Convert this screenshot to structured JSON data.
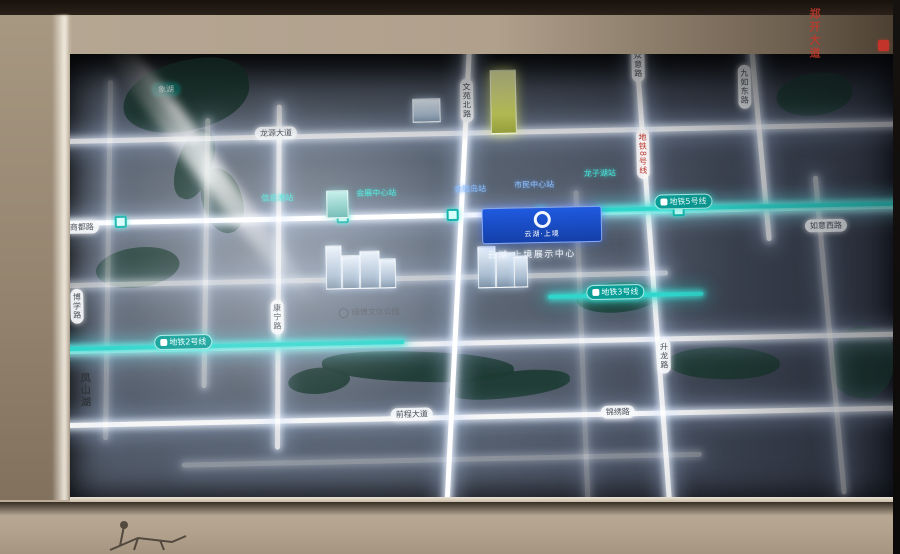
{
  "display": {
    "type": "illuminated wall map panel",
    "badge": {
      "title": "云湖·上境",
      "logo": "ring-logo"
    },
    "project_caption": "云湖·上境展示中心",
    "wall_side_vertical_text": "凤山湖",
    "wall_right_vertical_text": "郑开大道",
    "colors": {
      "metro_teal": "#2fd6cc",
      "road_glow": "#ffffff",
      "badge_blue": "#1f5ae0",
      "lake_green": "#1d3b33",
      "wall_beige": "#b3a390"
    },
    "metro_line_labels": [
      {
        "text": "地铁5号线",
        "x": 598,
        "y": 156,
        "vert": false
      },
      {
        "text": "地铁2号线",
        "x": 95,
        "y": 286,
        "vert": false
      },
      {
        "text": "地铁3号线",
        "x": 528,
        "y": 245,
        "vert": false
      }
    ],
    "metro_line_red_label": {
      "text": "地铁8号线",
      "x": 581,
      "y": 90
    },
    "road_pill_labels": [
      {
        "text": "龙源大道",
        "x": 200,
        "y": 80,
        "vert": false
      },
      {
        "text": "商都路",
        "x": 8,
        "y": 170,
        "vert": false
      },
      {
        "text": "前程大道",
        "x": 330,
        "y": 364,
        "vert": false
      },
      {
        "text": "锦绣路",
        "x": 540,
        "y": 366,
        "vert": false
      },
      {
        "text": "如意西路",
        "x": 748,
        "y": 184,
        "vert": false
      },
      {
        "text": "博学路",
        "x": 12,
        "y": 238,
        "vert": true
      },
      {
        "text": "康宁路",
        "x": 212,
        "y": 253,
        "vert": true
      },
      {
        "text": "文苑北路",
        "x": 406,
        "y": 36,
        "vert": true
      },
      {
        "text": "众意路",
        "x": 578,
        "y": 8,
        "vert": true
      },
      {
        "text": "九如东路",
        "x": 684,
        "y": 28,
        "vert": true
      },
      {
        "text": "升龙路",
        "x": 598,
        "y": 300,
        "vert": true
      }
    ],
    "station_labels": [
      {
        "text": "信息港站",
        "x": 205,
        "y": 146,
        "color": "teal"
      },
      {
        "text": "会展中心站",
        "x": 300,
        "y": 143,
        "color": "teal"
      },
      {
        "text": "金融岛站",
        "x": 398,
        "y": 141,
        "color": "blue"
      },
      {
        "text": "市民中心站",
        "x": 458,
        "y": 138,
        "color": "blue"
      },
      {
        "text": "龙子湖站",
        "x": 528,
        "y": 128,
        "color": "teal"
      }
    ],
    "station_dots_x": [
      58,
      280,
      390,
      478,
      616
    ],
    "poi_label": {
      "text": "绿博文化公园",
      "x": 280,
      "y": 262
    },
    "lake_label": {
      "text": "象湖",
      "x": 98,
      "y": 34
    },
    "roads_h": [
      {
        "y": 88,
        "x": 0,
        "w": 860,
        "o": 0.8
      },
      {
        "y": 170,
        "x": 0,
        "w": 860,
        "o": 1.0
      },
      {
        "y": 232,
        "x": 0,
        "w": 610,
        "o": 0.6
      },
      {
        "y": 298,
        "x": 0,
        "w": 860,
        "o": 0.9
      },
      {
        "y": 372,
        "x": 0,
        "w": 860,
        "o": 0.95
      },
      {
        "y": 414,
        "x": 120,
        "w": 520,
        "o": 0.35
      }
    ],
    "roads_v": [
      {
        "x": 48,
        "y": 30,
        "h": 360,
        "o": 0.35,
        "rot": 2
      },
      {
        "x": 146,
        "y": 70,
        "h": 270,
        "o": 0.5,
        "rot": 2
      },
      {
        "x": 218,
        "y": 58,
        "h": 345,
        "o": 0.8,
        "rot": 1.5
      },
      {
        "x": 398,
        "y": -10,
        "h": 480,
        "o": 1.0,
        "rot": 4
      },
      {
        "x": 520,
        "y": 150,
        "h": 310,
        "o": 0.3,
        "rot": -1
      },
      {
        "x": 592,
        "y": -10,
        "h": 480,
        "o": 0.9,
        "rot": -3
      },
      {
        "x": 702,
        "y": -10,
        "h": 215,
        "o": 0.8,
        "rot": -4
      },
      {
        "x": 768,
        "y": 140,
        "h": 320,
        "o": 0.55,
        "rot": -4
      }
    ],
    "teal_segments": [
      {
        "x": 540,
        "y": 168,
        "w": 320
      },
      {
        "x": 0,
        "y": 296,
        "w": 345
      },
      {
        "x": 490,
        "y": 254,
        "w": 155
      }
    ],
    "lakes": [
      {
        "x": 68,
        "y": 12,
        "w": 128,
        "h": 70,
        "r": "60% 40% 55% 45%",
        "rot": -8
      },
      {
        "x": 122,
        "y": 80,
        "w": 34,
        "h": 72,
        "r": "45%",
        "rot": 20
      },
      {
        "x": 146,
        "y": 120,
        "w": 40,
        "h": 66,
        "r": "48%",
        "rot": -15
      },
      {
        "x": 38,
        "y": 198,
        "w": 84,
        "h": 40,
        "r": "50%",
        "rot": -6
      },
      {
        "x": 228,
        "y": 322,
        "w": 62,
        "h": 26,
        "r": "50%",
        "rot": -4
      },
      {
        "x": 262,
        "y": 308,
        "w": 192,
        "h": 30,
        "r": "45%",
        "rot": 3
      },
      {
        "x": 388,
        "y": 330,
        "w": 122,
        "h": 26,
        "r": "45%",
        "rot": -5
      },
      {
        "x": 518,
        "y": 243,
        "w": 82,
        "h": 30,
        "r": "50%",
        "rot": -3
      },
      {
        "x": 608,
        "y": 310,
        "w": 112,
        "h": 32,
        "r": "48%",
        "rot": 2
      },
      {
        "x": 722,
        "y": 38,
        "w": 76,
        "h": 42,
        "r": "55% 45% 50% 50%",
        "rot": -5
      },
      {
        "x": 772,
        "y": 292,
        "w": 62,
        "h": 72,
        "r": "45%",
        "rot": 10
      }
    ],
    "buildings": [
      {
        "x": 268,
        "y": 200,
        "w": 14,
        "h": 42,
        "kind": "plain"
      },
      {
        "x": 284,
        "y": 210,
        "w": 16,
        "h": 32,
        "kind": "plain"
      },
      {
        "x": 302,
        "y": 206,
        "w": 18,
        "h": 36,
        "kind": "plain"
      },
      {
        "x": 322,
        "y": 214,
        "w": 14,
        "h": 28,
        "kind": "plain"
      },
      {
        "x": 420,
        "y": 204,
        "w": 16,
        "h": 40,
        "kind": "plain"
      },
      {
        "x": 438,
        "y": 210,
        "w": 18,
        "h": 34,
        "kind": "plain"
      },
      {
        "x": 456,
        "y": 214,
        "w": 12,
        "h": 30,
        "kind": "plain"
      },
      {
        "x": 358,
        "y": 55,
        "w": 26,
        "h": 22,
        "kind": "plain"
      },
      {
        "x": 436,
        "y": 28,
        "w": 24,
        "h": 62,
        "kind": "yellow"
      },
      {
        "x": 270,
        "y": 145,
        "w": 20,
        "h": 26,
        "kind": "teal"
      }
    ],
    "badge_box": {
      "x": 425,
      "y": 166,
      "w": 118,
      "h": 34
    },
    "caption_pos": {
      "x": 430,
      "y": 206
    },
    "dark_vtext_pos": {
      "x": 16,
      "y": 322
    },
    "glares": [
      {
        "cx": 155,
        "cy": 125,
        "len": 340,
        "wid": 26,
        "ang": 53
      },
      {
        "cx": 120,
        "cy": 60,
        "len": 180,
        "wid": 12,
        "ang": 53
      }
    ]
  }
}
